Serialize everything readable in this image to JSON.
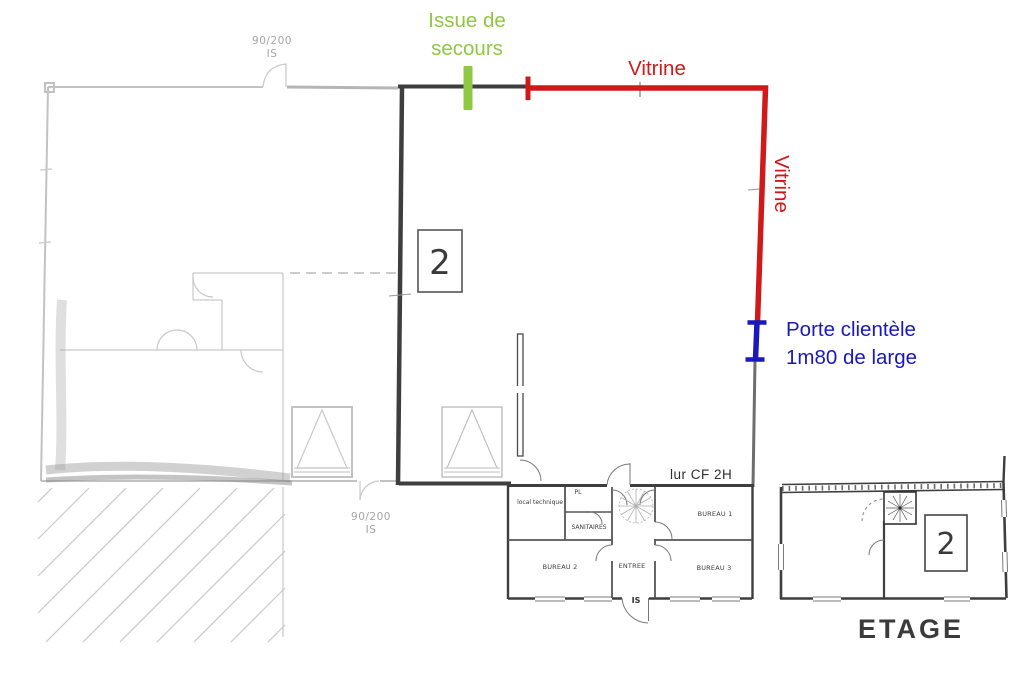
{
  "colors": {
    "green": "#8fc843",
    "red": "#d21919",
    "blue": "#1919be",
    "plan_dark": "#3e3e3e",
    "plan_gray": "#c2c2c2"
  },
  "annotations": {
    "issue_secours": {
      "line1": "Issue de",
      "line2": "secours"
    },
    "vitrine_top": "Vitrine",
    "vitrine_side": "Vitrine",
    "porte": {
      "line1": "Porte clientèle",
      "line2": "1m80 de large"
    }
  },
  "plan": {
    "unit_number": "2",
    "etage_unit_number": "2",
    "etage_label": "ETAGE",
    "fire_wall_label": "lur CF 2H",
    "door_label_top": {
      "line1": "90/200",
      "line2": "IS"
    },
    "door_label_bottom": {
      "line1": "90/200",
      "line2": "IS"
    },
    "rooms": {
      "local_technique": "local technique",
      "pl": "PL",
      "sanitaires": "SANITAIRES",
      "bureau1": "BUREAU 1",
      "bureau2": "BUREAU 2",
      "entree": "ENTREE",
      "bureau3": "BUREAU 3",
      "is_exit": "IS"
    }
  }
}
